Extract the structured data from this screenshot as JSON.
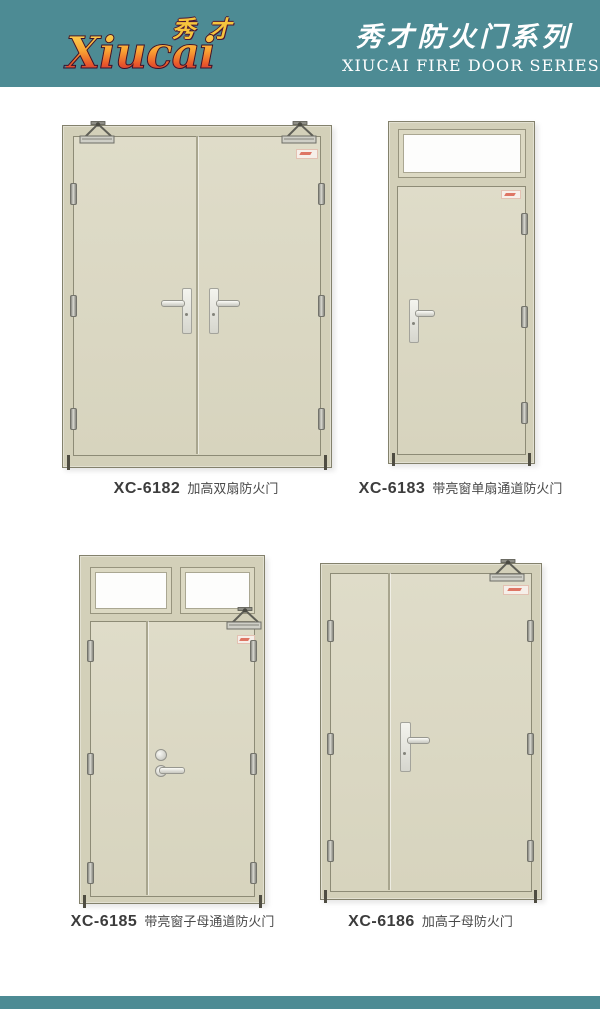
{
  "header": {
    "bg_color": "#4d8b94",
    "logo": {
      "cn": "秀才",
      "latin": "Xiucai"
    },
    "series_cn": "秀才防火门系列",
    "series_en": "XIUCAI FIRE DOOR SERIES"
  },
  "products": [
    {
      "model": "XC-6182",
      "name": "加高双扇防火门"
    },
    {
      "model": "XC-6183",
      "name": "带亮窗单扇通道防火门"
    },
    {
      "model": "XC-6185",
      "name": "带亮窗子母通道防火门"
    },
    {
      "model": "XC-6186",
      "name": "加高子母防火门"
    }
  ],
  "colors": {
    "band_teal": "#4d8b94",
    "door_frame_beige": "#d3d0b9",
    "door_leaf_beige": "#dcd9c4",
    "glass_white": "#fdfdfc",
    "label_accent_red": "#d95f4c"
  }
}
